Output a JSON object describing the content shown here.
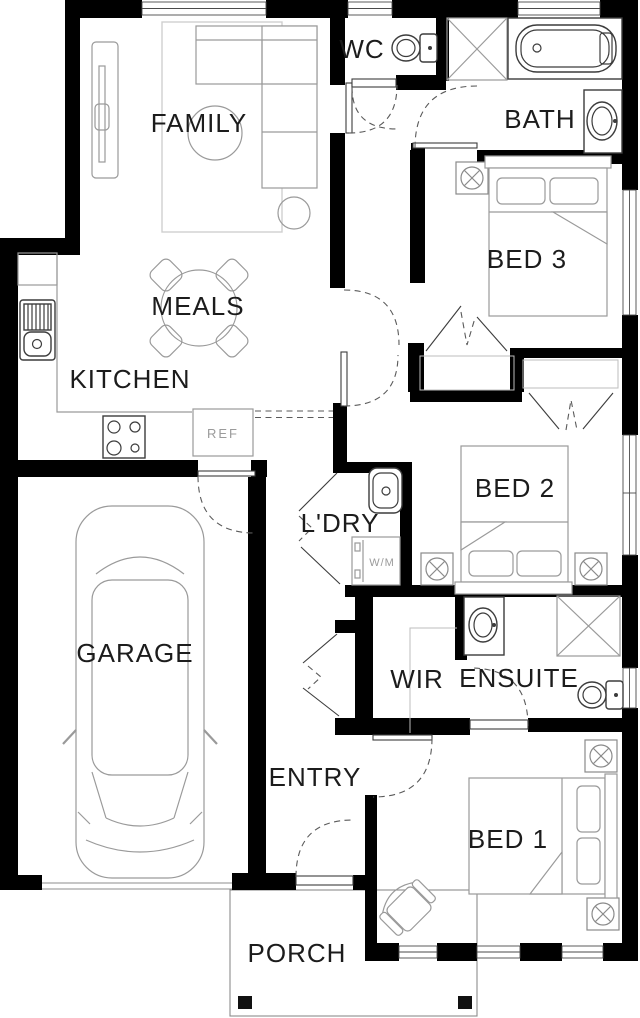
{
  "plan": {
    "type": "residential-floor-plan",
    "colors": {
      "wall": "#000000",
      "fixture_outline": "#3c3c3c",
      "furniture_outline": "#9a9a9a",
      "rug_outline": "#cfcfcf",
      "door_swing": "#5a5a5a",
      "label": "#1c1c1c",
      "muted_label": "#9b9b9b",
      "background": "#ffffff"
    },
    "rooms": {
      "family": {
        "label": "FAMILY"
      },
      "wc": {
        "label": "WC"
      },
      "bath": {
        "label": "BATH"
      },
      "bed3": {
        "label": "BED 3"
      },
      "meals": {
        "label": "MEALS"
      },
      "kitchen": {
        "label": "KITCHEN"
      },
      "laundry": {
        "label": "L'DRY"
      },
      "bed2": {
        "label": "BED 2"
      },
      "garage": {
        "label": "GARAGE"
      },
      "wir": {
        "label": "WIR"
      },
      "ensuite": {
        "label": "ENSUITE"
      },
      "entry": {
        "label": "ENTRY"
      },
      "bed1": {
        "label": "BED 1"
      },
      "porch": {
        "label": "PORCH"
      }
    },
    "appliances": {
      "fridge": {
        "label": "REF"
      },
      "washing_machine": {
        "label": "W/M"
      }
    }
  }
}
